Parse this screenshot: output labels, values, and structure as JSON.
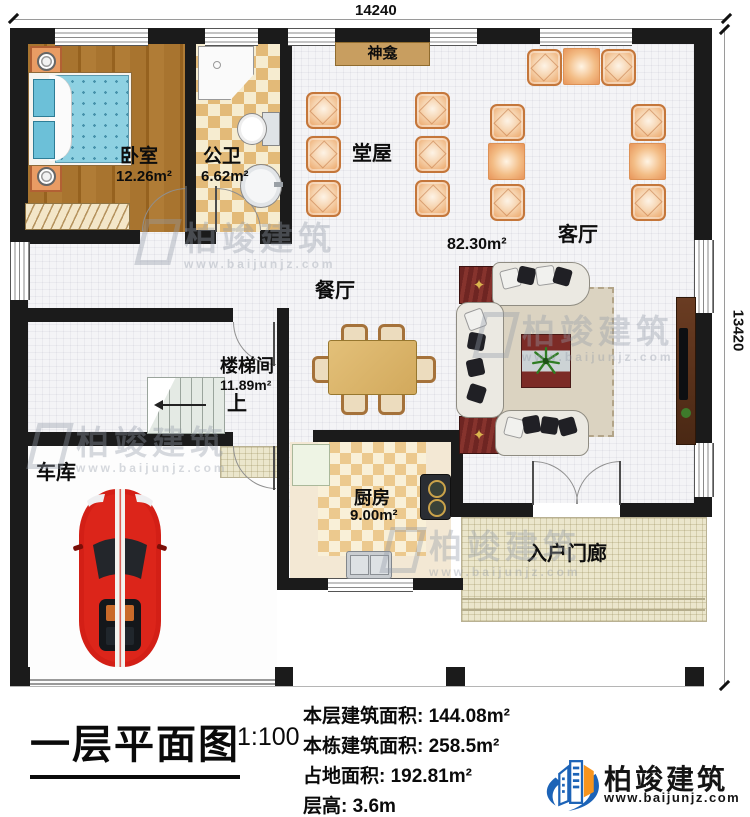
{
  "dimensions": {
    "top": "14240",
    "right": "13420"
  },
  "rooms": {
    "bedroom": {
      "name": "卧室",
      "area": "12.26m²"
    },
    "bathroom": {
      "name": "公卫",
      "area": "6.62m²"
    },
    "shrine": {
      "name": "神龛"
    },
    "hall": {
      "name": "堂屋"
    },
    "living": {
      "name": "客厅",
      "area": "82.30m²"
    },
    "dining": {
      "name": "餐厅"
    },
    "stairwell": {
      "name": "楼梯间",
      "area": "11.89m²",
      "up_label": "上"
    },
    "garage": {
      "name": "车库"
    },
    "kitchen": {
      "name": "厨房",
      "area": "9.00m²"
    },
    "porch": {
      "name": "入户门廊"
    }
  },
  "title_block": {
    "title": "一层平面图",
    "scale": "1:100",
    "stats": [
      {
        "label": "本层建筑面积:",
        "value": "144.08m²"
      },
      {
        "label": "本栋建筑面积:",
        "value": "258.5m²"
      },
      {
        "label": "占地面积:",
        "value": "192.81m²"
      },
      {
        "label": "层高:",
        "value": "3.6m"
      }
    ]
  },
  "brand": {
    "name": "柏竣建筑",
    "website": "www.baijunjz.com"
  },
  "watermark": {
    "name": "柏竣建筑",
    "website": "www.baijunjz.com"
  },
  "colors": {
    "wall": "#1b1b1b",
    "chair_wood": "#c4763a",
    "brand_blue": "#1c63b7",
    "brand_orange": "#f7941d",
    "car_red": "#d31f16"
  }
}
